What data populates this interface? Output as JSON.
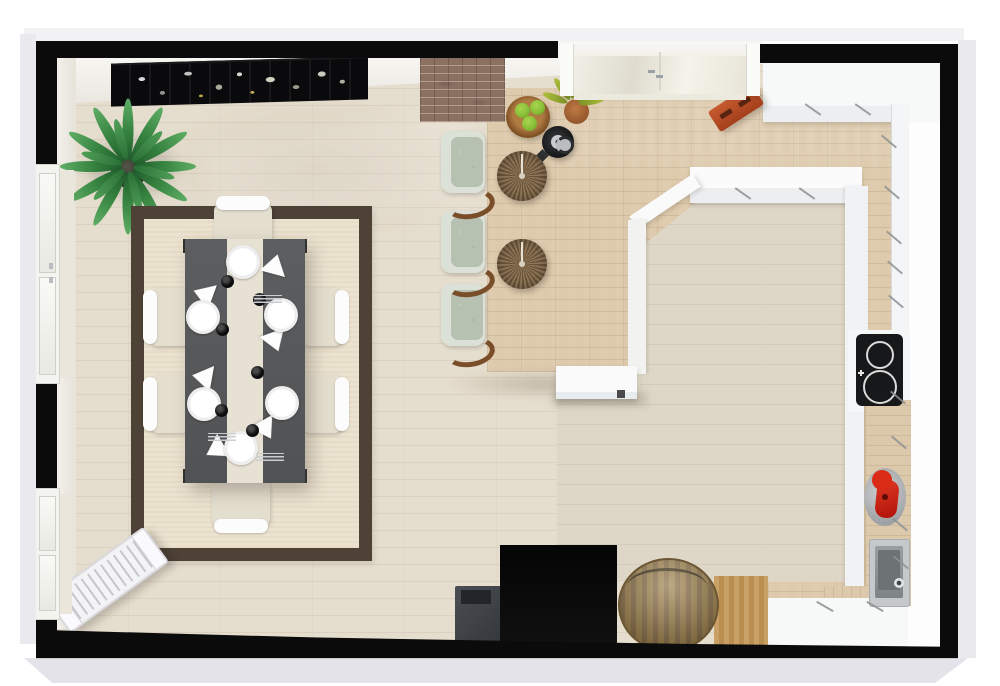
{
  "scene": {
    "kind": "3d-floor-plan-top-view",
    "rooms": [
      "dining-area",
      "kitchen"
    ],
    "visible_text": "none"
  },
  "palette": {
    "outside": "#e9e9ee",
    "outside-light": "#f2f2f5",
    "outside-dark": "#e3e3e9",
    "wall": "#0b0b0c",
    "floor-dining": "#e5ddcd",
    "floor-parquet": "#ddc9ab",
    "floor-pale": "#ded7c7",
    "counter-white": "#f7f8f8",
    "counter-face": "#eceef0",
    "wood-top": "#dcc9ab",
    "rug-border": "#4e4136",
    "rug-field": "#ebe2cf",
    "table-top": "#55585a",
    "runner": "#e7e1d3",
    "chair-seat": "#e4decf",
    "chair-rail": "#fcfcfc",
    "sage": "#b6c1b2",
    "sage-rim": "#dce1d8",
    "wood-leg": "#7a4e28",
    "stool-a": "#8f7757",
    "stool-b": "#6b543c",
    "brick": "#8b7162",
    "orange": "#c05327",
    "mixer-red": "#d92b16",
    "barrel": "#977b51",
    "apple": "#85bd35",
    "plant-green": "#35813f",
    "plant-yellow": "#aebf3a",
    "picture": "#0a0a0c",
    "cooktop": "#17181a",
    "steel": "#b9bcbe"
  },
  "inventory": {
    "dining_table_seats": 6,
    "place_settings": 6,
    "bar_stools": 2,
    "counter_chairs": 3,
    "windows": 2,
    "doors": 1,
    "appliances": [
      "cooktop",
      "sink",
      "stand-mixer",
      "kettle"
    ],
    "decor": [
      "city-wall-picture",
      "corner-plant",
      "counter-plant",
      "fruit-bowl",
      "area-rug",
      "radiator",
      "orange-step-stool",
      "barrel-table"
    ]
  },
  "placements": {
    "plates": [
      [
        243,
        262
      ],
      [
        203,
        317
      ],
      [
        281,
        315
      ],
      [
        204,
        404
      ],
      [
        282,
        403
      ],
      [
        241,
        448
      ]
    ],
    "cups": [
      [
        227,
        281
      ],
      [
        259,
        299
      ],
      [
        222,
        329
      ],
      [
        257,
        372
      ],
      [
        221,
        410
      ],
      [
        252,
        430
      ]
    ],
    "napkins": [
      [
        275,
        264,
        15
      ],
      [
        203,
        294,
        -70
      ],
      [
        275,
        342,
        160
      ],
      [
        202,
        377,
        -80
      ],
      [
        266,
        430,
        150
      ],
      [
        215,
        450,
        -120
      ]
    ],
    "cutlery": [
      [
        268,
        299
      ],
      [
        222,
        437
      ],
      [
        270,
        457
      ]
    ],
    "dining_chairs": [
      {
        "x": 214,
        "y": 203,
        "o": "n"
      },
      {
        "x": 212,
        "y": 480,
        "o": "s"
      },
      {
        "x": 150,
        "y": 288,
        "o": "w"
      },
      {
        "x": 150,
        "y": 375,
        "o": "w"
      },
      {
        "x": 302,
        "y": 288,
        "o": "e"
      },
      {
        "x": 302,
        "y": 375,
        "o": "e"
      }
    ],
    "table_legs": [
      [
        183,
        239
      ],
      [
        294,
        239
      ],
      [
        183,
        469
      ],
      [
        294,
        469
      ]
    ],
    "sage_chairs": [
      [
        441,
        131
      ],
      [
        441,
        211
      ],
      [
        441,
        284
      ]
    ],
    "sage_legs": [
      [
        445,
        189
      ],
      [
        445,
        267
      ],
      [
        445,
        337
      ]
    ],
    "bar_stools": [
      [
        497,
        151
      ],
      [
        497,
        239
      ]
    ],
    "apples": [
      [
        9,
        7
      ],
      [
        24,
        4
      ],
      [
        16,
        20
      ]
    ],
    "corner_plant_leaves": {
      "angles": [
        0,
        30,
        60,
        90,
        120,
        150,
        180,
        210,
        240,
        270,
        300,
        330
      ],
      "length": 62,
      "width": 11
    },
    "corner_plant_inner_leaves": {
      "angles": [
        15,
        75,
        135,
        195,
        255,
        315
      ],
      "length": 42,
      "width": 9
    },
    "counter_plant_leaves": {
      "angles": [
        -160,
        -125,
        -95,
        -65,
        -35,
        -10
      ],
      "length": 26,
      "width": 7
    },
    "cabinet_ticks": [
      [
        812,
        100,
        -55
      ],
      [
        862,
        100,
        -55
      ],
      [
        742,
        184,
        -55
      ],
      [
        806,
        184,
        -55
      ],
      [
        888,
        132,
        -50
      ],
      [
        891,
        183,
        -50
      ],
      [
        893,
        228,
        -50
      ],
      [
        894,
        258,
        -50
      ],
      [
        895,
        292,
        -50
      ],
      [
        897,
        388,
        -50
      ],
      [
        898,
        433,
        -50
      ],
      [
        899,
        515,
        -50
      ],
      [
        900,
        553,
        -50
      ],
      [
        824,
        597,
        -60
      ],
      [
        874,
        597,
        -60
      ]
    ]
  }
}
